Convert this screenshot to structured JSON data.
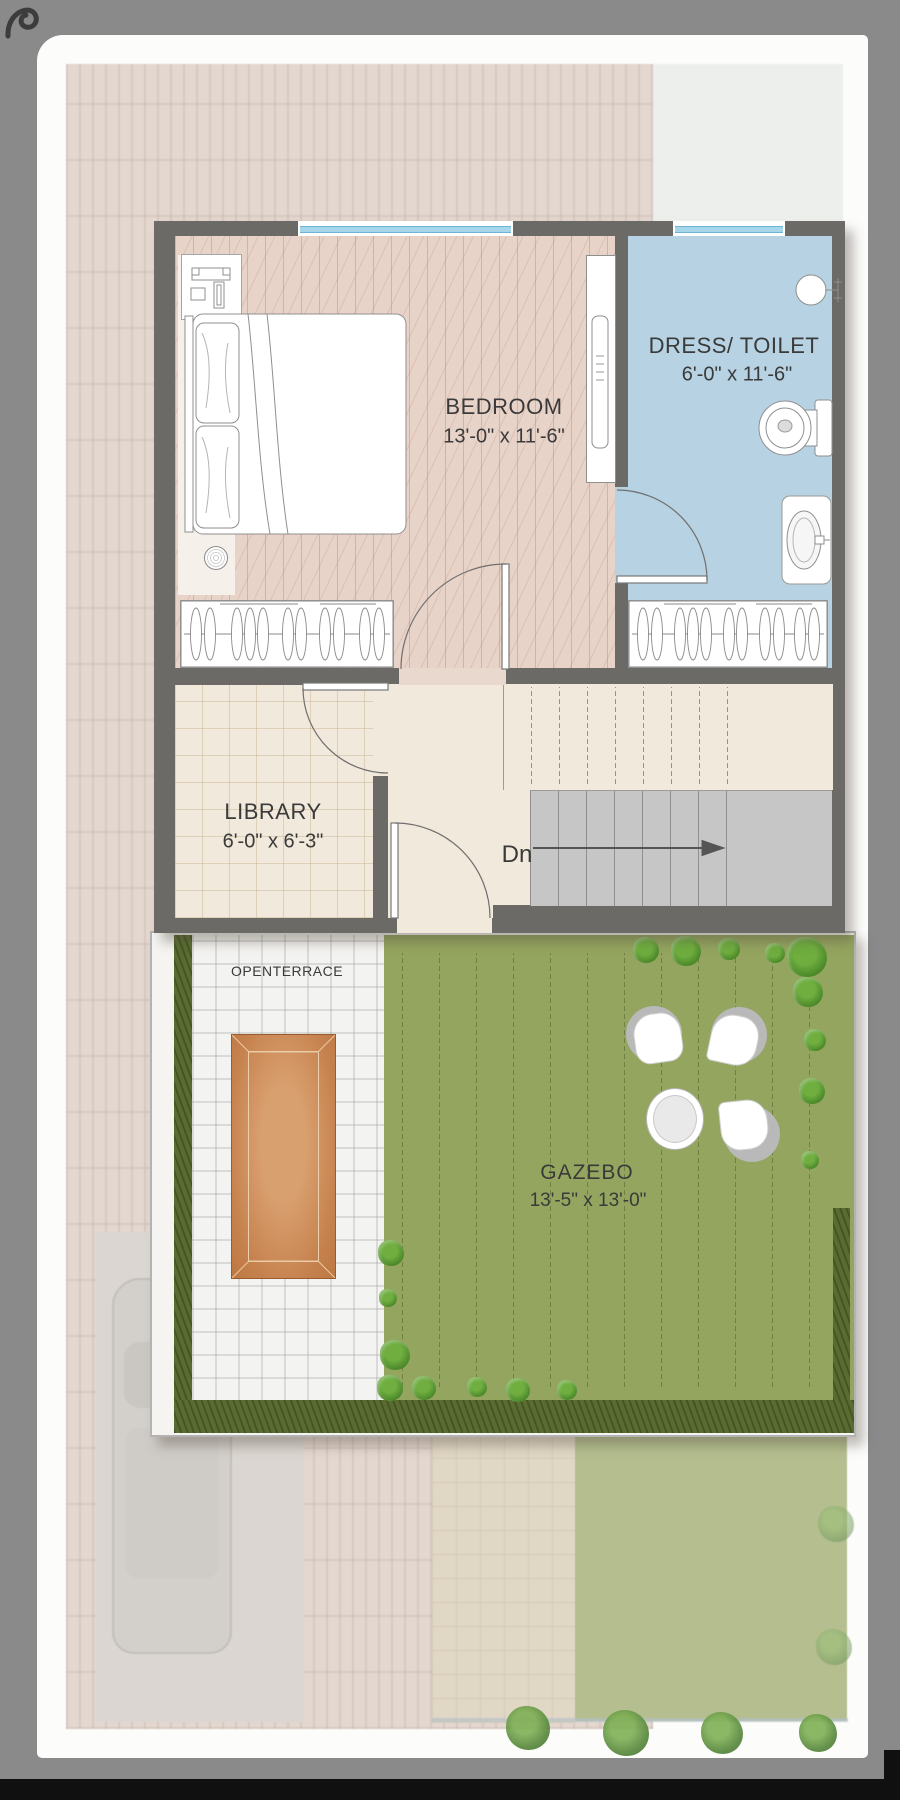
{
  "rooms": {
    "bedroom": {
      "name": "BEDROOM",
      "dims": "13'-0\" x 11'-6\""
    },
    "dress_toilet": {
      "name": "DRESS/ TOILET",
      "dims": "6'-0\" x 11'-6\""
    },
    "library": {
      "name": "LIBRARY",
      "dims": "6'-0\" x 6'-3\""
    },
    "open_terrace": {
      "name": "OPENTERRACE"
    },
    "gazebo": {
      "name": "GAZEBO",
      "dims": "13'-5\" x 13'-0\""
    }
  },
  "stairs": {
    "down_label": "Dn"
  },
  "palette": {
    "wall": "#6b6a67",
    "bedroom_floor": "#e8d3c9",
    "toilet_floor": "#b7d3e3",
    "beige_floor": "#f1e9db",
    "stair_gray": "#c6c6c6",
    "terrace_white": "#f3f3f1",
    "gazebo_green": "#94a55f",
    "hedge_green": "#5a6c31",
    "wood_deck": "#c6824e",
    "frame_gray": "#8a8a8a"
  }
}
